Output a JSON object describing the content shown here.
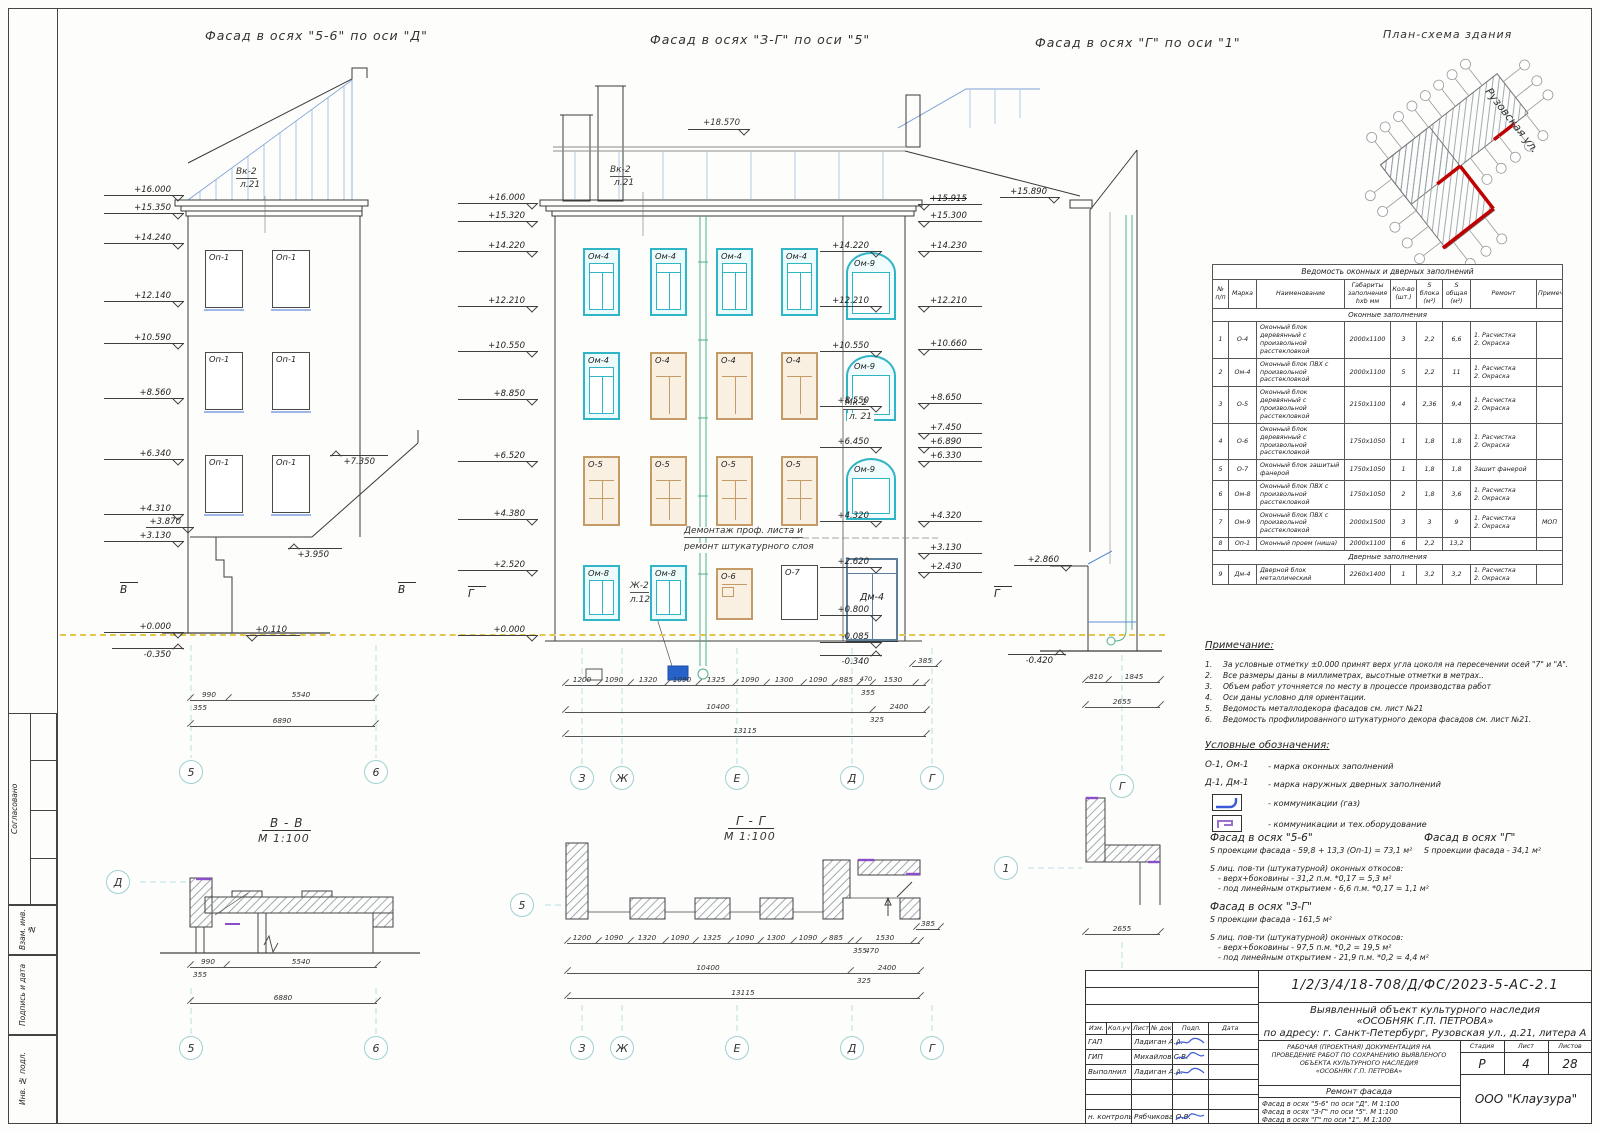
{
  "titles": {
    "f1": "Фасад  в осях \"5-6\" по оси \"Д\"",
    "f2": "Фасад  в осях \"З-Г\" по оси \"5\"",
    "f3": "Фасад  в осях \"Г\" по оси \"1\"",
    "plan": "План-схема здания",
    "street": "Рузовская ул."
  },
  "axes": {
    "a5": "5",
    "a6": "6",
    "az": "З",
    "azh": "Ж",
    "ae": "Е",
    "ad": "Д",
    "ag": "Г",
    "a1": "1",
    "b": "В",
    "g": "Г"
  },
  "sec": {
    "bb": "В - В",
    "gg": "Г - Г",
    "scale": "М 1:100"
  },
  "f1": {
    "win_label": "Оп-1",
    "vk1": "Вк-2",
    "vk2": "л.21",
    "elevL": [
      "+16.000",
      "+15.350",
      "+14.240",
      "+12.140",
      "+10.590",
      "+8.560",
      "+6.340",
      "+4.310",
      "+3.130",
      "+0.000",
      "-0.350"
    ],
    "elevR": [
      "+7.350",
      "+3.870",
      "+3.950",
      "+0.110"
    ],
    "dims": [
      "990",
      "5540",
      "355",
      "6890"
    ]
  },
  "f2": {
    "top": "+18.570",
    "vk1": "Вк-2",
    "vk2": "л.21",
    "mk1": "Мк-2",
    "mk2": "л. 21",
    "zh1": "Ж-2",
    "zh2": "л.12",
    "dem1": "Демонтаж проф. листа и",
    "dem2": "ремонт штукатурного слоя",
    "w": {
      "om4": "Ом-4",
      "o4": "О-4",
      "o5": "О-5",
      "om8": "Ом-8",
      "o6": "О-6",
      "o7": "О-7",
      "om9": "Ом-9",
      "dm4": "Дм-4"
    },
    "elevL": [
      "+16.000",
      "+15.320",
      "+14.220",
      "+12.210",
      "+10.550",
      "+8.850",
      "+6.520",
      "+4.380",
      "+2.520",
      "+0.000"
    ],
    "elevI": [
      "+14.220",
      "+12.210",
      "+10.550",
      "+8.550",
      "+6.450",
      "+4.320",
      "+2.620",
      "+0.800",
      "-0.085",
      "-0.340"
    ],
    "elevO": [
      "+15.915",
      "+15.300",
      "+14.230",
      "+12.210",
      "+10.660",
      "+8.650",
      "+7.450",
      "+6.890",
      "+6.330",
      "+4.320",
      "+3.130",
      "+2.430"
    ],
    "dims1": [
      "1200",
      "1090",
      "1320",
      "1090",
      "1325",
      "1090",
      "1300",
      "1090",
      "885",
      "470",
      "1530"
    ],
    "dims2": [
      "385",
      "355",
      "10400",
      "2400",
      "325",
      "13115"
    ]
  },
  "f3": {
    "elev": [
      "+15.890",
      "+2.860",
      "-0.420"
    ],
    "dims": [
      "810",
      "1845",
      "2655"
    ]
  },
  "bb": {
    "dims": [
      "990",
      "5540",
      "355",
      "6880"
    ]
  },
  "table": {
    "title": "Ведомость оконных и дверных заполнений",
    "headers": [
      "№\nп/п",
      "Марка",
      "Наименование",
      "Габариты\nзаполнения\nhxb мм",
      "Кол-во\n(шт.)",
      "S\nблока\n(м²)",
      "S\nобщая\n(м²)",
      "Ремонт",
      "Примечание"
    ],
    "rows": [
      {
        "section": "Оконные заполнения"
      },
      {
        "cells": [
          "1",
          "О-4",
          "Оконный блок деревянный с произвольной расстекловкой",
          "2000x1100",
          "3",
          "2,2",
          "6,6",
          "1. Расчистка\n2. Окраска",
          ""
        ]
      },
      {
        "cells": [
          "2",
          "Ом-4",
          "Оконный блок ПВХ с произвольной расстекловкой",
          "2000x1100",
          "5",
          "2,2",
          "11",
          "1. Расчистка\n2. Окраска",
          ""
        ]
      },
      {
        "cells": [
          "3",
          "О-5",
          "Оконный блок деревянный с произвольной расстекловкой",
          "2150x1100",
          "4",
          "2,36",
          "9,4",
          "1. Расчистка\n2. Окраска",
          ""
        ]
      },
      {
        "cells": [
          "4",
          "О-6",
          "Оконный блок деревянный с произвольной расстекловкой",
          "1750x1050",
          "1",
          "1,8",
          "1,8",
          "1. Расчистка\n2. Окраска",
          ""
        ]
      },
      {
        "cells": [
          "5",
          "О-7",
          "Оконный блок зашитый фанерой",
          "1750x1050",
          "1",
          "1,8",
          "1,8",
          "Зашит фанерой",
          ""
        ]
      },
      {
        "cells": [
          "6",
          "Ом-8",
          "Оконный блок ПВХ с произвольной расстекловкой",
          "1750x1050",
          "2",
          "1,8",
          "3,6",
          "1. Расчистка\n2. Окраска",
          ""
        ]
      },
      {
        "cells": [
          "7",
          "Ом-9",
          "Оконный блок ПВХ с произвольной расстекловкой",
          "2000x1500",
          "3",
          "3",
          "9",
          "1. Расчистка\n2. Окраска",
          "МОП"
        ]
      },
      {
        "cells": [
          "8",
          "Оп-1",
          "Оконный проем (ниша)",
          "2000x1100",
          "6",
          "2,2",
          "13,2",
          "",
          ""
        ]
      },
      {
        "section": "Дверные заполнения"
      },
      {
        "cells": [
          "9",
          "Дм-4",
          "Дверной блок металлический",
          "2260x1400",
          "1",
          "3,2",
          "3,2",
          "1. Расчистка\n2. Окраска",
          ""
        ]
      }
    ]
  },
  "notes": {
    "title": "Примечание:",
    "items": [
      {
        "n": "1.",
        "t": "За условные отметку ±0.000 принят верх угла цоколя на пересечении осей \"7\" и \"А\"."
      },
      {
        "n": "2.",
        "t": "Все размеры даны в миллиметрах, высотные отметки в метрах.."
      },
      {
        "n": "3.",
        "t": "Объем работ уточняется по месту в процессе производства работ"
      },
      {
        "n": "4.",
        "t": "Оси даны условно для ориентации."
      },
      {
        "n": "5.",
        "t": "Ведомость металлодекора фасадов см. лист №21"
      },
      {
        "n": "6.",
        "t": "Ведомость профилированного штукатурного декора фасадов см. лист №21."
      }
    ]
  },
  "legend": {
    "title": "Условные обозначения:",
    "m1": "О-1, Ом-1",
    "t1": "-   марка оконных заполнений",
    "m2": "Д-1, Дм-1",
    "t2": "-   марка наружных дверных заполнений",
    "t3": "-   коммуникации (газ)",
    "t4": "-   коммуникации  и  тех.оборудование"
  },
  "areas": {
    "f56_title": "Фасад в осях \"5-6\"",
    "f56_l1": "S проекции фасада - 59,8 + 13,3 (Оп-1) = 73,1 м²",
    "f56_sub": "S лиц. пов-ти (штукатурной) оконных откосов:",
    "f56_b1": "-    верх+боковины - 31,2 п.м. *0,17 = 5,3 м²",
    "f56_b2": "-    под линейным открытием  - 6,6 п.м. *0,17 = 1,1 м²",
    "fg_title": "Фасад в осях \"Г\"",
    "fg_l1": "S проекции фасада - 34,1 м²",
    "f3g_title": "Фасад в осях \"З-Г\"",
    "f3g_l1": "S проекции фасада - 161,5 м²",
    "f3g_sub": "S лиц. пов-ти (штукатурной) оконных откосов:",
    "f3g_b1": "-    верх+боковины - 97,5 п.м. *0,2 = 19,5 м²",
    "f3g_b2": "-    под линейным открытием  - 21,9 п.м. *0,2 = 4,4 м²"
  },
  "tb": {
    "doc": "1/2/3/4/18-708/Д/ФС/2023-5-АС-2.1",
    "obj1": "Выявленный объект культурного наследия",
    "obj2": "«ОСОБНЯК Г.П. ПЕТРОВА»",
    "obj3": "по адресу: г. Санкт-Петербург, Рузовская ул., д.21, литера А",
    "h1": "Изм.",
    "h2": "Кол.уч",
    "h3": "Лист",
    "h4": "№ док.",
    "h5": "Подп.",
    "h6": "Дата",
    "r1": "ГАП",
    "n1": "Ладиган А.А.",
    "r2": "ГИП",
    "n2": "Михайлов С.В.",
    "r3": "Выполнил",
    "n3": "Ладиган А.А.",
    "r4": "н. контроль",
    "n4": "Рябчикова О.В.",
    "d1": "РАБОЧАЯ (ПРОЕКТНАЯ) ДОКУМЕНТАЦИЯ НА",
    "d2": "ПРОВЕДЕНИЕ РАБОТ ПО СОХРАНЕНИЮ ВЫЯВЛЕНОГО",
    "d3": "ОБЪЕКТА КУЛЬТУРНОГО НАСЛЕДИЯ",
    "d4": "«ОСОБНЯК Г.П. ПЕТРОВА»",
    "work": "Ремонт фасада",
    "s1": "Фасад  в осях \"5-6\" по оси \"Д\". М 1:100",
    "s2": "Фасад  в осях \"З-Г\" по оси \"5\". М 1:100",
    "s3": "Фасад  в осях \"Г\" по оси \"1\". М 1:100",
    "stage_l": "Стадия",
    "sheet_l": "Лист",
    "sheets_l": "Листов",
    "stage": "Р",
    "sheet": "4",
    "sheets": "28",
    "company": "ООО  \"Клаузура\""
  },
  "strip": {
    "s1": "Согласовано",
    "s2": "Взам. инв. №",
    "s3": "Подпись и дата",
    "s4": "Инв. № подл."
  }
}
